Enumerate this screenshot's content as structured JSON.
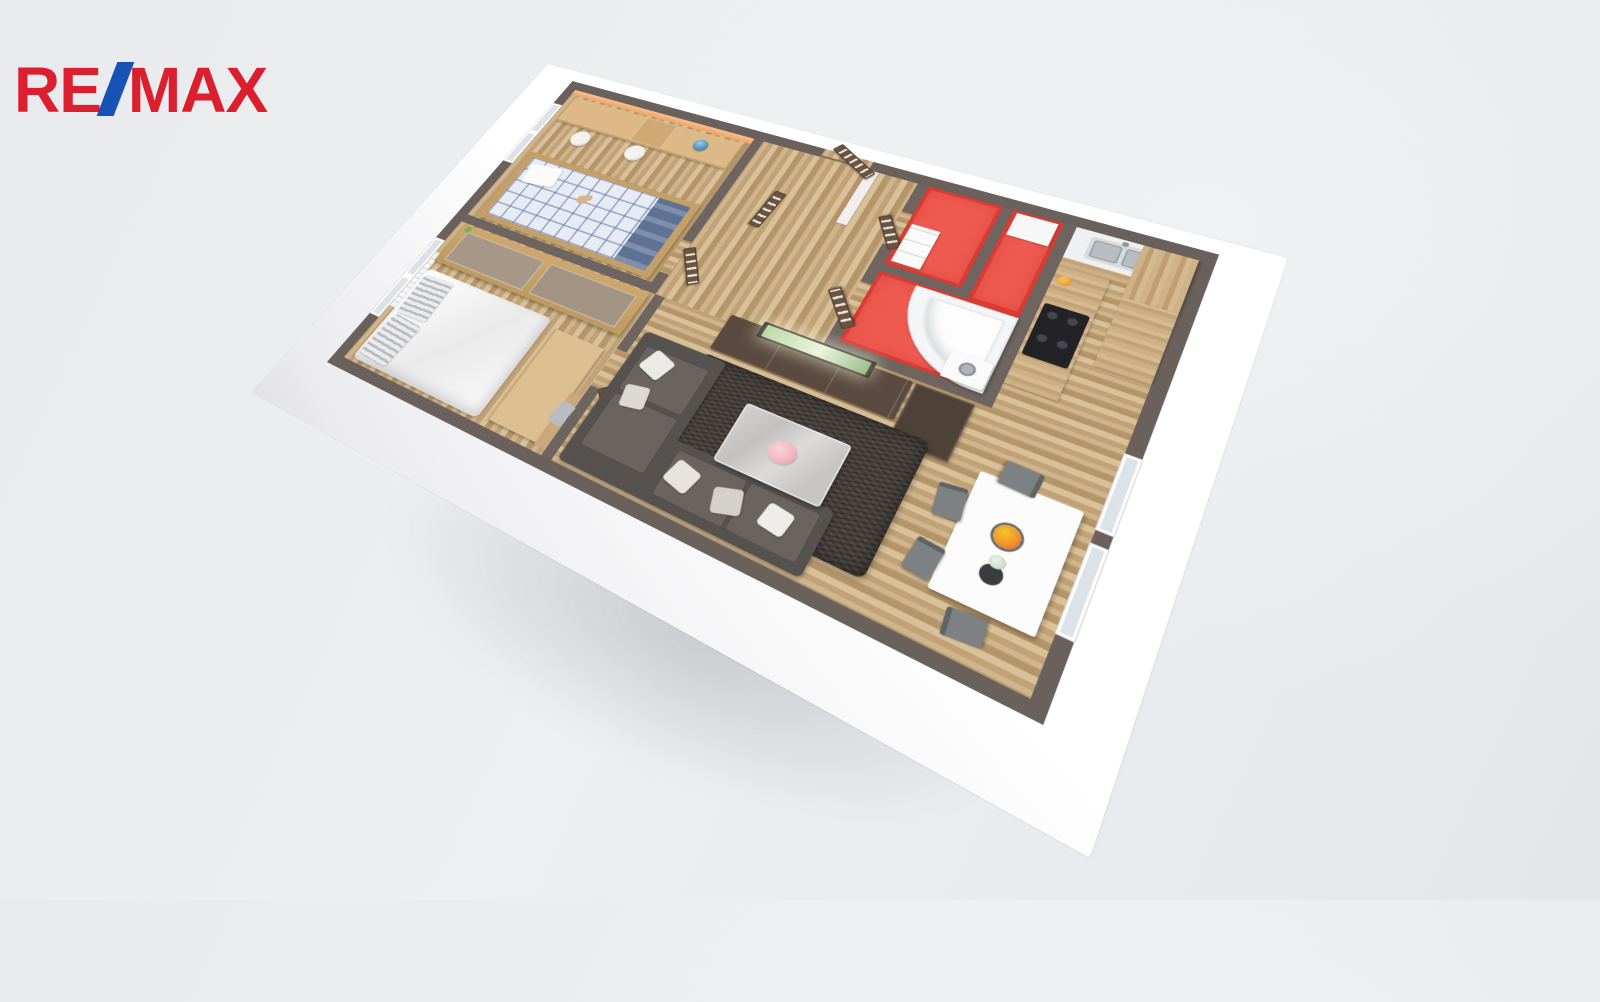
{
  "logo": {
    "re": "RE",
    "slash": "/",
    "max": "MAX",
    "red": "#dc1f2e",
    "blue": "#1753b5"
  },
  "scene": {
    "kind": "isometric-3d-floorplan-render",
    "background": "#eaecee",
    "palette": {
      "wall_top": "#6e6460",
      "outer_wall": "#ffffff",
      "wood_light": "#d8c098",
      "wood_dark": "#b59468",
      "red_room": "#ef5a50",
      "accent_orange_wall": "#f0a266",
      "sofa": "#56524f",
      "rug": "#45403b",
      "door": "#6a5544"
    },
    "rooms": [
      {
        "name": "children-bedroom",
        "items": [
          "desk",
          "two office chairs",
          "globe",
          "bed with plaid duvet",
          "blue blanket",
          "teddy bear",
          "orange accent wall",
          "west window"
        ]
      },
      {
        "name": "master-bedroom",
        "items": [
          "double bed with white duvet",
          "striped pillows",
          "sliding-door wardrobe",
          "sideboard",
          "coat rack with towel",
          "radiator",
          "west window"
        ]
      },
      {
        "name": "hallway",
        "items": [
          "entry door",
          "five dark slatted doors",
          "white partition stub"
        ]
      },
      {
        "name": "wc",
        "items": [
          "white drawer cabinet",
          "red walls"
        ]
      },
      {
        "name": "bathroom",
        "items": [
          "corner bathtub",
          "washing machine",
          "white shelf",
          "red walls"
        ]
      },
      {
        "name": "kitchen",
        "items": [
          "sink counter",
          "faucet",
          "black cooktop",
          "tall pantry cabinet",
          "fruit bowl"
        ]
      },
      {
        "name": "living-room",
        "items": [
          "corner sofa",
          "throw pillows",
          "shaggy rug",
          "marble coffee table with pink flowers",
          "tv wall unit",
          "tv",
          "tall cabinet"
        ]
      },
      {
        "name": "dining-area",
        "items": [
          "white table",
          "four gray chairs",
          "fruit bowl",
          "vase with flowers",
          "two east windows"
        ]
      }
    ]
  }
}
